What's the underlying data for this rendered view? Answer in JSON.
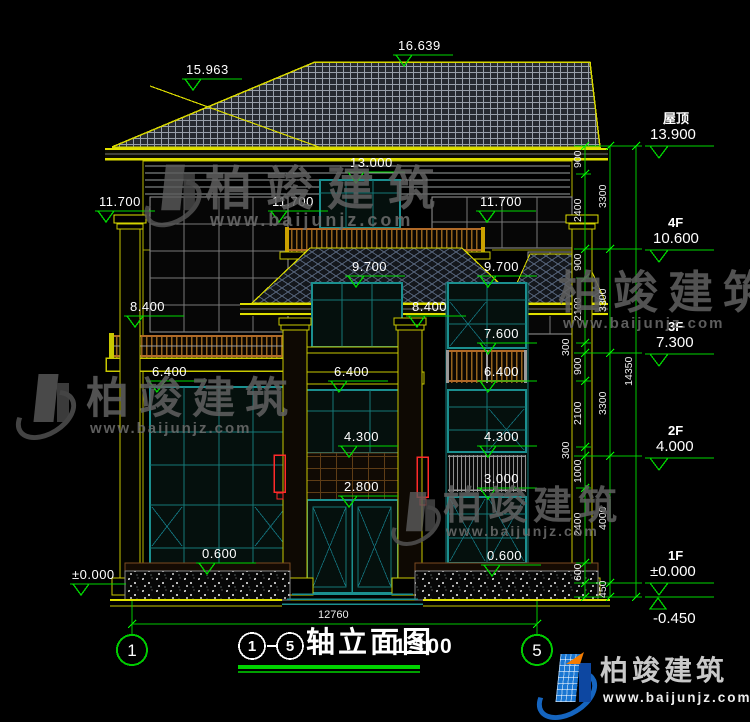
{
  "title": {
    "axis_start": "1",
    "axis_end": "5",
    "name": "轴立面图",
    "scale": "1:100"
  },
  "levels": {
    "roof": {
      "name": "屋顶",
      "elev": "13.900"
    },
    "f4": {
      "name": "4F",
      "elev": "10.600"
    },
    "f3": {
      "name": "3F",
      "elev": "7.300"
    },
    "f2": {
      "name": "2F",
      "elev": "4.000"
    },
    "f1": {
      "name": "1F",
      "elev": "±0.000"
    },
    "ground": {
      "elev": "-0.450"
    }
  },
  "spot": {
    "ridge": "16.639",
    "hip": "15.963",
    "v13000": "13.000",
    "v11700": "11.700",
    "v9700": "9.700",
    "v8400": "8.400",
    "v7600": "7.600",
    "v6400": "6.400",
    "v4300": "4.300",
    "v3000": "3.000",
    "v2800": "2.800",
    "v0600": "0.600",
    "zero": "±0.000"
  },
  "dims": {
    "inner": [
      "900",
      "2400",
      "900",
      "2100",
      "300",
      "900",
      "2100",
      "300",
      "1000",
      "2400",
      "600"
    ],
    "floors": [
      "3300",
      "3300",
      "3300",
      "4000",
      "450"
    ],
    "total": "14350",
    "bottom": "12760"
  },
  "watermark": {
    "brand": "柏竣建筑",
    "url": "www.baijunjz.com"
  },
  "colors": {
    "line_yellow": "#d8d800",
    "line_green": "#00cc00",
    "frame_teal": "#1b8f8f",
    "accent_red": "#ff2a2a",
    "text_white": "#ffffff"
  }
}
